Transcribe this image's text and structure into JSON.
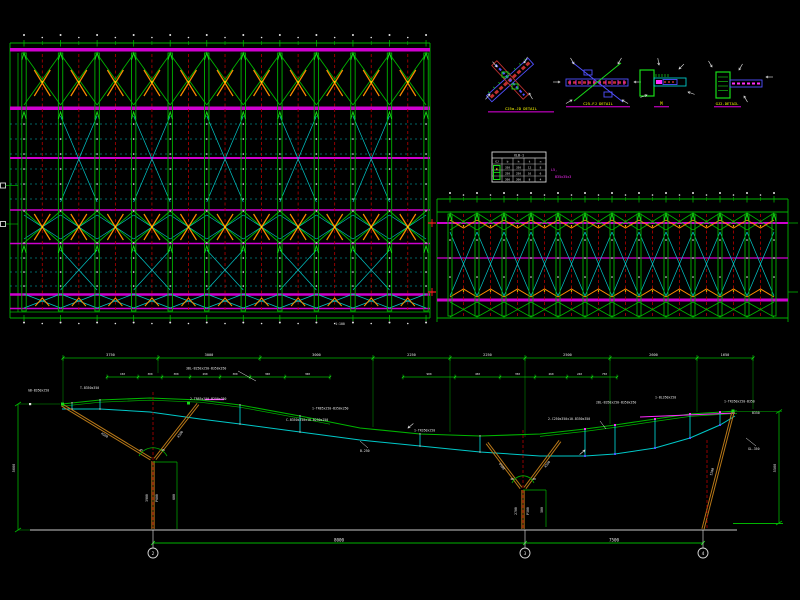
{
  "canvas": {
    "bg": "#000000"
  },
  "colors": {
    "green": "#00b400",
    "green_bright": "#18dc18",
    "cyan": "#00c8c8",
    "magenta": "#cf00cf",
    "magenta_bright": "#ff2bff",
    "red": "#b40000",
    "red_bright": "#ff2020",
    "orange": "#ff8c00",
    "yellow": "#ffff00",
    "white": "#e6e6e6",
    "blue": "#5050ff",
    "column_brown": "#b87818",
    "ground_gray": "#a0a0a0"
  },
  "details": {
    "items": [
      {
        "label": "C25a-JD DETAIL"
      },
      {
        "label": "C25-FJ DETAIL"
      },
      {
        "label": "M"
      },
      {
        "label": "GJ2-DETAIL"
      }
    ]
  },
  "schedule_table": {
    "title": "XLB-1",
    "headers": [
      "GJ",
      "b",
      "h",
      "t",
      "n"
    ],
    "rows": [
      [
        "",
        "350",
        "350",
        "12",
        "8"
      ],
      [
        "",
        "250",
        "250",
        "10",
        "6"
      ],
      [
        "",
        "200",
        "200",
        "8",
        "4"
      ]
    ],
    "note_line1": "L5,",
    "note_line2": "B35x35x3"
  },
  "plans": {
    "left_note": "1:100"
  },
  "elevation": {
    "dims_top": [
      "3750",
      "3000",
      "3000",
      "2250",
      "2250",
      "2500",
      "2600",
      "1650"
    ],
    "dims_second_left": [
      "150",
      "300",
      "300",
      "290",
      "300",
      "300",
      "300"
    ],
    "dims_second_right": [
      "900",
      "450",
      "350",
      "260",
      "240",
      "750"
    ],
    "dims_bottom": [
      "8000",
      "7500"
    ],
    "dim_left_vertical": "5000",
    "dim_right_vertical": "5500",
    "bubbles": [
      "2",
      "3",
      "4"
    ],
    "angle_labels": [
      "45",
      "45",
      "40",
      "40"
    ],
    "labels": [
      {
        "x": 28,
        "y": 391.5,
        "t": "GB-B350x250"
      },
      {
        "x": 80,
        "y": 389,
        "t": "T-B350x350"
      },
      {
        "x": 186,
        "y": 369.5,
        "t": "3BL-B250x250-B350x350",
        "lead": [
          238,
          371,
          256,
          381
        ]
      },
      {
        "x": 190,
        "y": 400,
        "t": "2-TR85x250-B250x350"
      },
      {
        "x": 312,
        "y": 409.5,
        "t": "1-TR85x250-B350x250"
      },
      {
        "x": 286,
        "y": 421,
        "t": "C-B350x250x10-B250x250"
      },
      {
        "x": 360,
        "y": 452,
        "t": "B-250",
        "lead": [
          368,
          448,
          360,
          441
        ]
      },
      {
        "x": 414,
        "y": 431.5,
        "t": "1-TR350x250"
      },
      {
        "x": 548,
        "y": 420,
        "t": "2-C250x350x10-B350x350",
        "lead": [
          600,
          421,
          606,
          429
        ]
      },
      {
        "x": 596,
        "y": 403.5,
        "t": "2BL-B350x250-B350x350"
      },
      {
        "x": 655,
        "y": 398.5,
        "t": "1-BL350x250"
      },
      {
        "x": 724,
        "y": 402.5,
        "t": "1-TR350x250-B350"
      },
      {
        "x": 752,
        "y": 414,
        "t": "B350"
      },
      {
        "x": 748,
        "y": 450,
        "t": "GL-350",
        "lead": [
          756,
          446,
          746,
          438
        ]
      }
    ],
    "rot_labels": [
      {
        "x": 104,
        "y": 436,
        "t": "4500",
        "r": 31
      },
      {
        "x": 181,
        "y": 435,
        "t": "4500",
        "r": -53
      },
      {
        "x": 148,
        "y": 498,
        "t": "3900",
        "r": -90
      },
      {
        "x": 158,
        "y": 498,
        "t": "P600",
        "r": -90
      },
      {
        "x": 501,
        "y": 467,
        "t": "4500",
        "r": 53
      },
      {
        "x": 548,
        "y": 465,
        "t": "4500",
        "r": -51
      },
      {
        "x": 517,
        "y": 511,
        "t": "2700",
        "r": -90
      },
      {
        "x": 529,
        "y": 511,
        "t": "P500",
        "r": -90
      },
      {
        "x": 713,
        "y": 472,
        "t": "5200",
        "r": -74
      },
      {
        "x": 175,
        "y": 497,
        "t": "600",
        "r": -90
      },
      {
        "x": 543,
        "y": 510,
        "t": "500",
        "r": -90
      }
    ]
  }
}
